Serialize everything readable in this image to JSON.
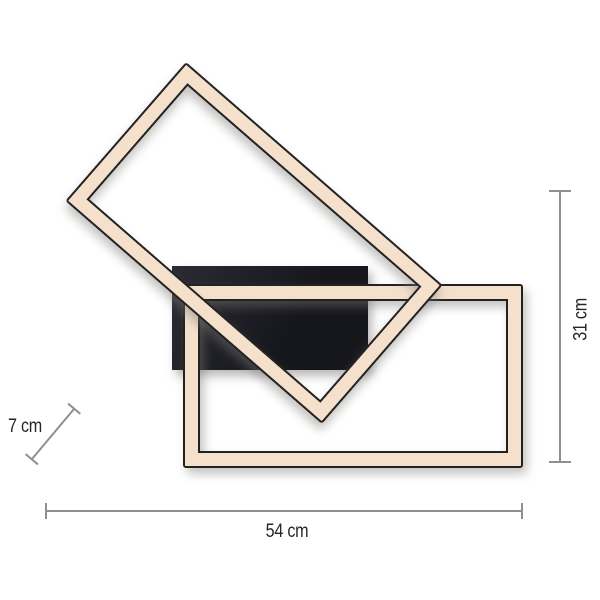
{
  "dimensions": {
    "width": {
      "label": "54 cm"
    },
    "height": {
      "label": "31 cm"
    },
    "depth": {
      "label": "7 cm"
    }
  },
  "colors": {
    "background": "#ffffff",
    "frame-fill": "#f5e0cc",
    "frame-outline": "#222222",
    "plate-dark": "#16161d",
    "plate-light": "#2b2b34",
    "dim-line": "#8f8f8f",
    "label-text": "#262626"
  }
}
